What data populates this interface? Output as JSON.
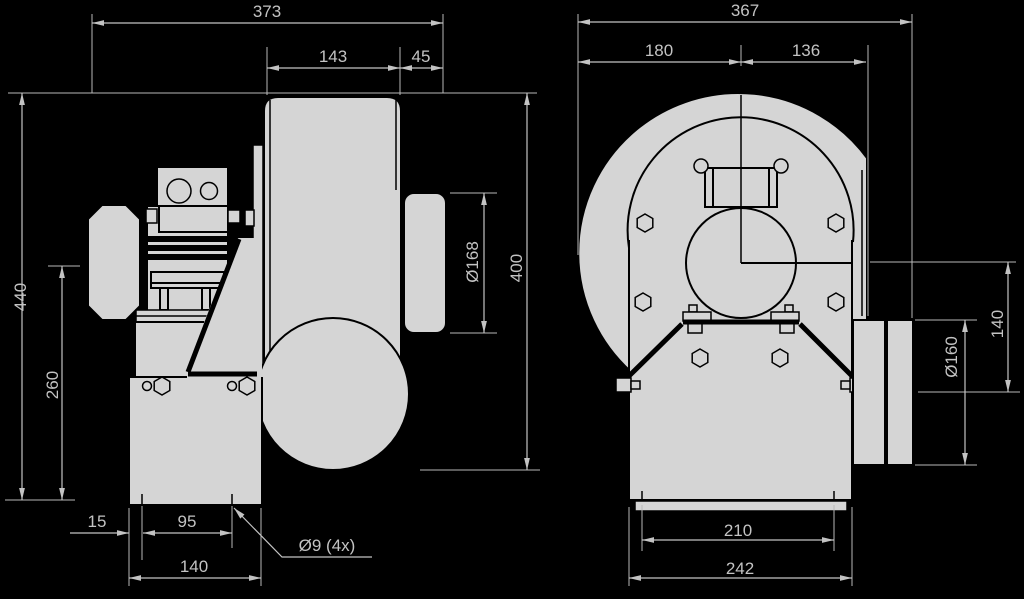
{
  "app": {
    "type": "technical-drawing",
    "background": "#000000",
    "shape_fill": "#d5d5d5",
    "outline_color": "#000000",
    "dimension_color": "#c3c3c3"
  },
  "drawing": {
    "side_view": {
      "overall_width": "373",
      "housing_width": "143",
      "inlet_offset": "45",
      "overall_height": "440",
      "axis_height": "260",
      "inlet_diameter": "Ø168",
      "outlet_drop": "400",
      "foot_edge": "15",
      "foot_holes": "95",
      "foot_width": "140",
      "hole_note": "Ø9 (4x)"
    },
    "front_view": {
      "overall_width": "367",
      "left_of_axis": "180",
      "right_of_axis": "136",
      "outlet_diameter": "Ø160",
      "axis_to_outlet": "140",
      "base_holes": "210",
      "base_width": "242"
    }
  }
}
